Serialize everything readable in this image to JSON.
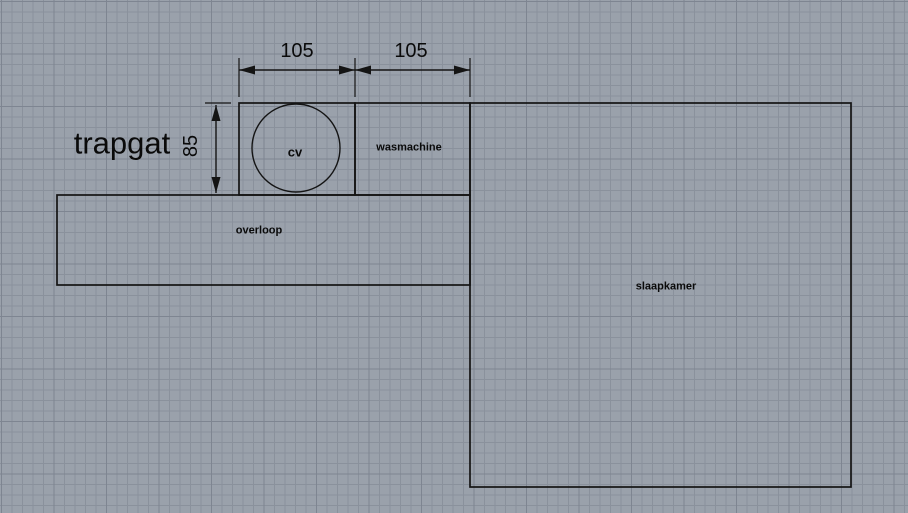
{
  "colors": {
    "background": "#9aa1ab",
    "grid_minor": "#8a919c",
    "grid_major": "#7e8591",
    "line": "#141414",
    "text": "#0a0a0a"
  },
  "plan": {
    "stairwell_label": "trapgat",
    "rooms": [
      {
        "name": "cv",
        "label": "cv",
        "x": 239,
        "y": 103,
        "w": 116,
        "h": 92
      },
      {
        "name": "wasmachine",
        "label": "wasmachine",
        "x": 355,
        "y": 103,
        "w": 115,
        "h": 92
      },
      {
        "name": "overloop",
        "label": "overloop",
        "x": 57,
        "y": 195,
        "w": 413,
        "h": 90
      },
      {
        "name": "slaapkamer",
        "label": "slaapkamer",
        "x": 470,
        "y": 103,
        "w": 381,
        "h": 384
      }
    ],
    "boiler_circle": {
      "cx": 296,
      "cy": 148,
      "r": 44
    },
    "dimensions": [
      {
        "name": "cv-width",
        "label": "105",
        "type": "h",
        "x1": 239,
        "x2": 355,
        "y": 70,
        "ext": [
          {
            "x": 239,
            "y1": 58,
            "y2": 97
          },
          {
            "x": 355,
            "y1": 58,
            "y2": 97
          }
        ]
      },
      {
        "name": "wasmachine-width",
        "label": "105",
        "type": "h",
        "x1": 355,
        "x2": 470,
        "y": 70,
        "ext": [
          {
            "x": 470,
            "y1": 58,
            "y2": 97
          }
        ]
      },
      {
        "name": "trapgat-height",
        "label": "85",
        "type": "v",
        "x": 216,
        "y1": 105,
        "y2": 193,
        "ext": [
          {
            "x1": 205,
            "x2": 231,
            "y": 103
          }
        ]
      }
    ]
  }
}
